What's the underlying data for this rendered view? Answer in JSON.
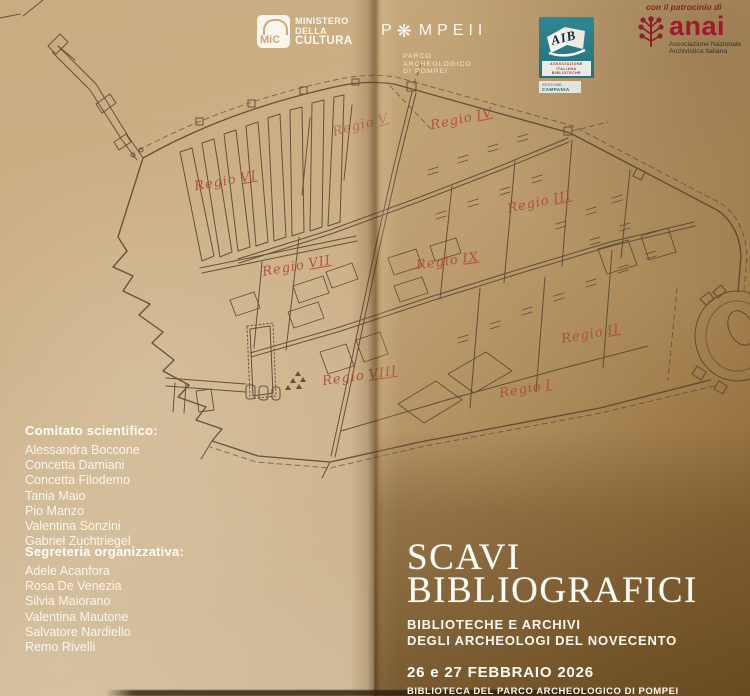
{
  "header": {
    "patronage": "con il patrocinio di",
    "mic": {
      "badge": "MiC",
      "line1": "MINISTERO",
      "line2": "DELLA",
      "line3": "CULTURA"
    },
    "pompeii": {
      "part1": "P",
      "part2": "MPEII",
      "sub1": "PARCO",
      "sub2": "ARCHEOLOGICO",
      "sub3": "DI POMPEI"
    },
    "aib": {
      "acronym": "AIB",
      "sub1": "ASSOCIAZIONE",
      "sub2": "ITALIANA",
      "sub3": "BIBLIOTECHE",
      "section1": "SEZIONE",
      "section2": "CAMPANIA"
    },
    "anai": {
      "acronym": "anai",
      "sub1": "Associazione Nazionale",
      "sub2": "Archivistica Italiana"
    }
  },
  "map": {
    "regions": [
      {
        "prefix": "Regio",
        "num": "V"
      },
      {
        "prefix": "Regio",
        "num": "IV"
      },
      {
        "prefix": "Regio",
        "num": "VI"
      },
      {
        "prefix": "Regio",
        "num": "III"
      },
      {
        "prefix": "Regio",
        "num": "VII"
      },
      {
        "prefix": "Regio",
        "num": "IX"
      },
      {
        "prefix": "Regio",
        "num": "II"
      },
      {
        "prefix": "Regio",
        "num": "VIII"
      },
      {
        "prefix": "Regio",
        "num": "I"
      }
    ]
  },
  "committees": {
    "scientific": {
      "title": "Comitato scientifico:",
      "members": [
        "Alessandra Boccone",
        "Concetta Damiani",
        "Concetta Filodemo",
        "Tania Maio",
        "Pio Manzo",
        "Valentina Sonzini",
        "Gabriel Zuchtriegel"
      ]
    },
    "secretariat": {
      "title": "Segreteria organizzativa:",
      "members": [
        "Adele Acanfora",
        "Rosa De Venezia",
        "Silvia Maiorano",
        "Valentina Mautone",
        "Salvatore Nardiello",
        "Remo Rivelli"
      ]
    }
  },
  "event": {
    "title_line1": "SCAVI",
    "title_line2": "BIBLIOGRAFICI",
    "subtitle_line1": "BIBLIOTECHE E ARCHIVI",
    "subtitle_line2": "DEGLI ARCHEOLOGI DEL NOVECENTO",
    "date": "26 e 27 FEBBRAIO 2026",
    "venue": "BIBLIOTECA DEL PARCO ARCHEOLOGICO DI POMPEI"
  },
  "colors": {
    "paper_light": "#d6bc95",
    "paper_dark": "#87622f",
    "map_ink": "#564430",
    "regio_red": "#b5483d",
    "aib_teal": "#2f8694",
    "anai_red": "#9e1b2f",
    "text_white": "#fbf6ec"
  }
}
